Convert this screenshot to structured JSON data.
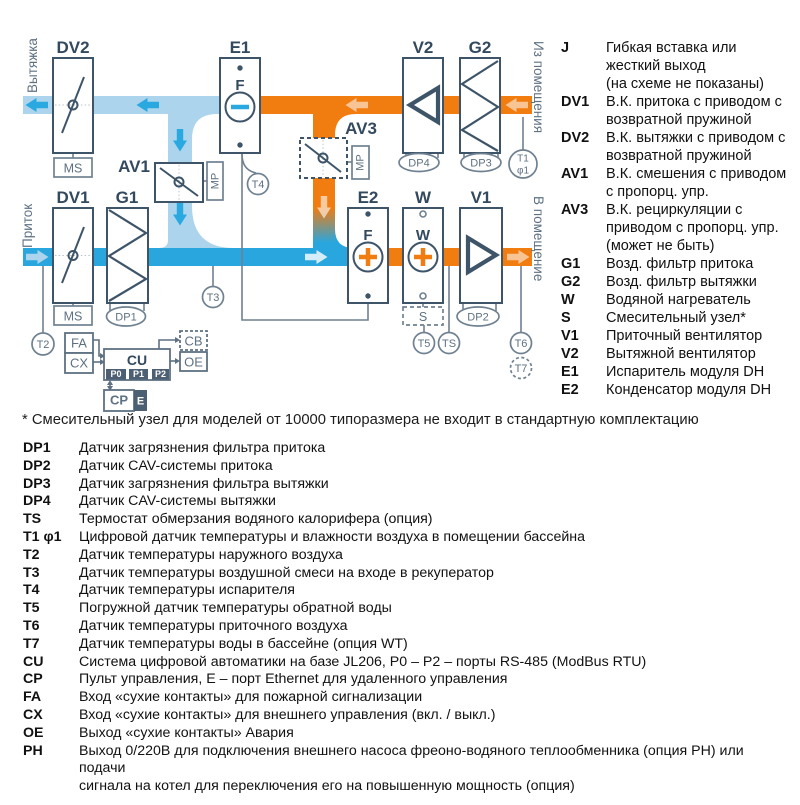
{
  "diagram": {
    "labels": {
      "vytyazhka": "Вытяжка",
      "pritok": "Приток",
      "iz_pomeshcheniya": "Из помещения",
      "v_pomeshchenie": "В помещение",
      "dv2": "DV2",
      "e1": "E1",
      "v2": "V2",
      "g2": "G2",
      "av1": "AV1",
      "av3": "AV3",
      "dv1": "DV1",
      "g1": "G1",
      "e2": "E2",
      "w": "W",
      "v1": "V1",
      "ms": "MS",
      "mp": "MP",
      "f": "F",
      "w_letter": "W",
      "t1": "T1",
      "phi1": "φ1",
      "t2": "T2",
      "t3": "T3",
      "t4": "T4",
      "t5": "T5",
      "t6": "T6",
      "t7": "T7",
      "ts": "TS",
      "dp1": "DP1",
      "dp2": "DP2",
      "dp3": "DP3",
      "dp4": "DP4",
      "s": "S",
      "fa": "FA",
      "cx": "CX",
      "cu": "CU",
      "cb": "CB",
      "oe": "OE",
      "cp": "CP",
      "e": "E",
      "p0": "P0",
      "p1": "P1",
      "p2": "P2"
    },
    "colors": {
      "orange": "#F17C10",
      "supply_blue": "#29A6DE",
      "light_blue": "#ACD4EC",
      "outline_dark": "#3E5468",
      "line_gray": "#6F8191",
      "label_dark": "#33495E",
      "text_gray": "#5E7183",
      "tab_dark": "#4D5F73"
    }
  },
  "legend": {
    "items": [
      {
        "key": "J",
        "text": "Гибкая вставка или\nжесткий выход\n(на схеме не показаны)"
      },
      {
        "key": "DV1",
        "text": "В.К. притока с приводом с\nвозвратной пружиной"
      },
      {
        "key": "DV2",
        "text": "В.К. вытяжки с приводом с\nвозвратной пружиной"
      },
      {
        "key": "AV1",
        "text": "В.К. смешения с приводом\nс пропорц. упр."
      },
      {
        "key": "AV3",
        "text": "В.К. рециркуляции с\nприводом с пропорц. упр.\n(может не быть)"
      },
      {
        "key": "G1",
        "text": "Возд. фильтр притока"
      },
      {
        "key": "G2",
        "text": "Возд. фильтр вытяжки"
      },
      {
        "key": "W",
        "text": "Водяной нагреватель"
      },
      {
        "key": "S",
        "text": "Смесительный узел*"
      },
      {
        "key": "V1",
        "text": "Приточный вентилятор"
      },
      {
        "key": "V2",
        "text": "Вытяжной вентилятор"
      },
      {
        "key": "E1",
        "text": "Испаритель модуля DH"
      },
      {
        "key": "E2",
        "text": "Конденсатор модуля DH"
      }
    ]
  },
  "footnote": "* Смесительный узел для моделей от 10000 типоразмера не входит в стандартную комплектацию",
  "sensor_list": {
    "items": [
      {
        "key": "DP1",
        "text": "Датчик загрязнения фильтра притока"
      },
      {
        "key": "DP2",
        "text": "Датчик CAV-системы притока"
      },
      {
        "key": "DP3",
        "text": "Датчик загрязнения фильтра вытяжки"
      },
      {
        "key": "DP4",
        "text": "Датчик CAV-системы вытяжки"
      },
      {
        "key": "TS",
        "text": "Термостат обмерзания водяного калорифера (опция)"
      },
      {
        "key": "T1 φ1",
        "text": "Цифровой датчик температуры и влажности воздуха в помещении бассейна"
      },
      {
        "key": "T2",
        "text": "Датчик температуры наружного воздуха"
      },
      {
        "key": "T3",
        "text": "Датчик температуры воздушной смеси на входе в рекуператор"
      },
      {
        "key": "T4",
        "text": "Датчик температуры испарителя"
      },
      {
        "key": "T5",
        "text": "Погружной датчик температуры обратной воды"
      },
      {
        "key": "T6",
        "text": "Датчик температуры приточного воздуха"
      },
      {
        "key": "T7",
        "text": "Датчик температуры воды в бассейне (опция WT)"
      },
      {
        "key": "CU",
        "text": "Система цифровой автоматики на базе JL206, P0 – P2 – порты RS-485 (ModBus RTU)"
      },
      {
        "key": "CP",
        "text": "Пульт управления, E – порт Ethernet для удаленного управления"
      },
      {
        "key": "FA",
        "text": "Вход «сухие контакты» для пожарной сигнализации"
      },
      {
        "key": "CX",
        "text": "Вход «сухие контакты» для внешнего управления (вкл. / выкл.)"
      },
      {
        "key": "OE",
        "text": "Выход «сухие контакты» Авария"
      },
      {
        "key": "PH",
        "text": "Выход 0/220В для подключения внешнего насоса фреоно-водяного теплообменника (опция PH) или подачи\nсигнала на котел для переключения его на повышенную мощность (опция)"
      }
    ]
  }
}
